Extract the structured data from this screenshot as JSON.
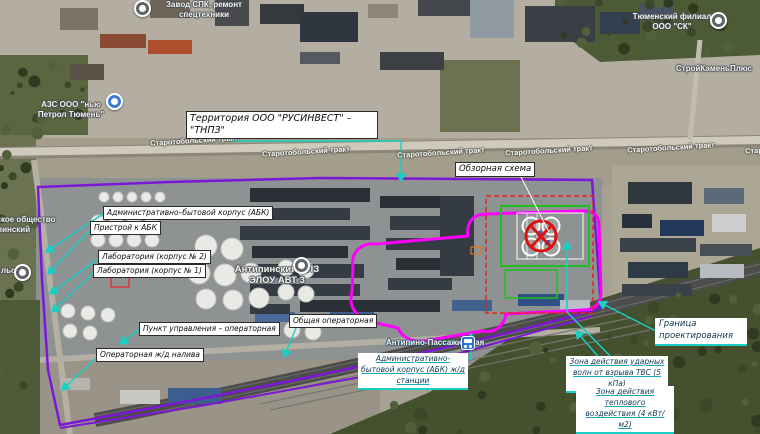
{
  "map": {
    "road_label": "Старотобольский тракт",
    "pois": {
      "factory": "Завод СПК, ремонт спецтехники",
      "gas_station": "АЗС ООО \"нью Петрол Тюмень\"",
      "tyumen_branch": "Тюменский филиал ООО \"СК\"",
      "stroykamen": "СтройКаменьПлюс",
      "garden_society": "Садоводческое общество Антипинский",
      "refinery": "Антипинский НПЗ",
      "refinery_unit": "ЭЛОУ АВТ 3",
      "station": "Антипино-Пассажирская",
      "poi_fragment": "льс"
    }
  },
  "callouts": {
    "territory": "Территория ООО \"РУСИНВЕСТ\" – \"ТНПЗ\"",
    "abk": "Административно–бытовой корпус (АБК)",
    "abk_annex": "Пристрой к АБК",
    "lab2": "Лаборатория (корпус № 2)",
    "lab1": "Лаборатория (корпус № 1)",
    "control_point": "Пункт управления – операторная",
    "rail_loading_operator": "Операторная ж/д налива",
    "common_operator": "Общая операторная",
    "station_abk": "Административно-бытовой корпус (АБК) ж/д станции",
    "overview_scheme": "Обзорная схема",
    "design_boundary": "Граница проектирования",
    "shock_zone": "Зона действия ударных волн от взрыва ТВС (5 кПа)",
    "thermal_zone": "Зона действия теплового воздействия (4 кВт/м2)"
  },
  "colors": {
    "boundary_purple": "#7d17d6",
    "zone_magenta": "#ff00ff",
    "leader_cyan": "#19cfc4",
    "hazard_red": "#dd2222",
    "plan_green": "#22bb22"
  }
}
